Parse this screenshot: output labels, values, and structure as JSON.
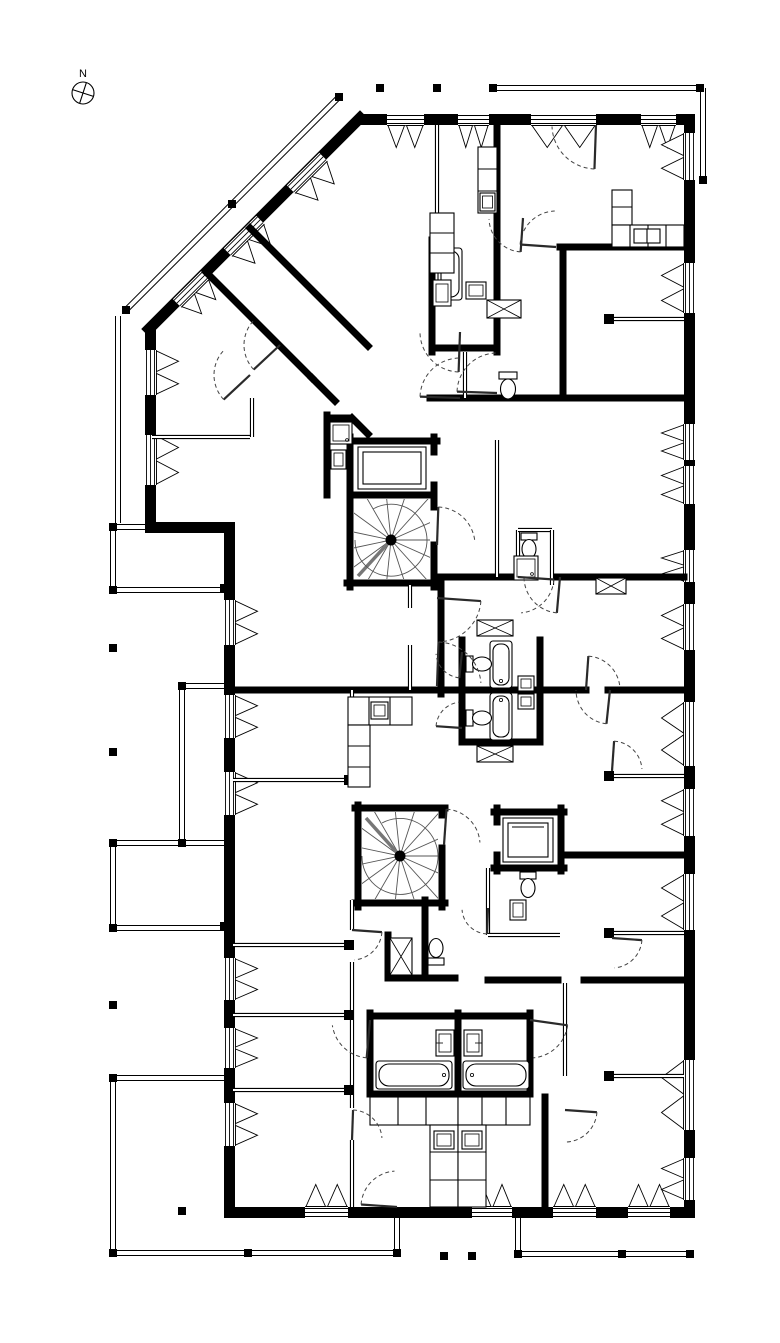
{
  "compass": {
    "label": "N"
  },
  "palette": {
    "ink": "#000000",
    "paper": "#ffffff",
    "door_arc": "#444444",
    "tread": "#555555"
  },
  "drawing": {
    "kind": "architectural floor plan",
    "icons": [
      "north-arrow-icon",
      "spiral-stair-icon",
      "elevator-icon",
      "bathtub-icon",
      "toilet-icon",
      "sink-icon",
      "shower-icon",
      "wardrobe-icon",
      "kitchen-counter-icon",
      "window-icon",
      "window-vent-icon",
      "door-swing-icon",
      "column-icon",
      "railing-post-icon",
      "balcony-railing-icon"
    ]
  }
}
